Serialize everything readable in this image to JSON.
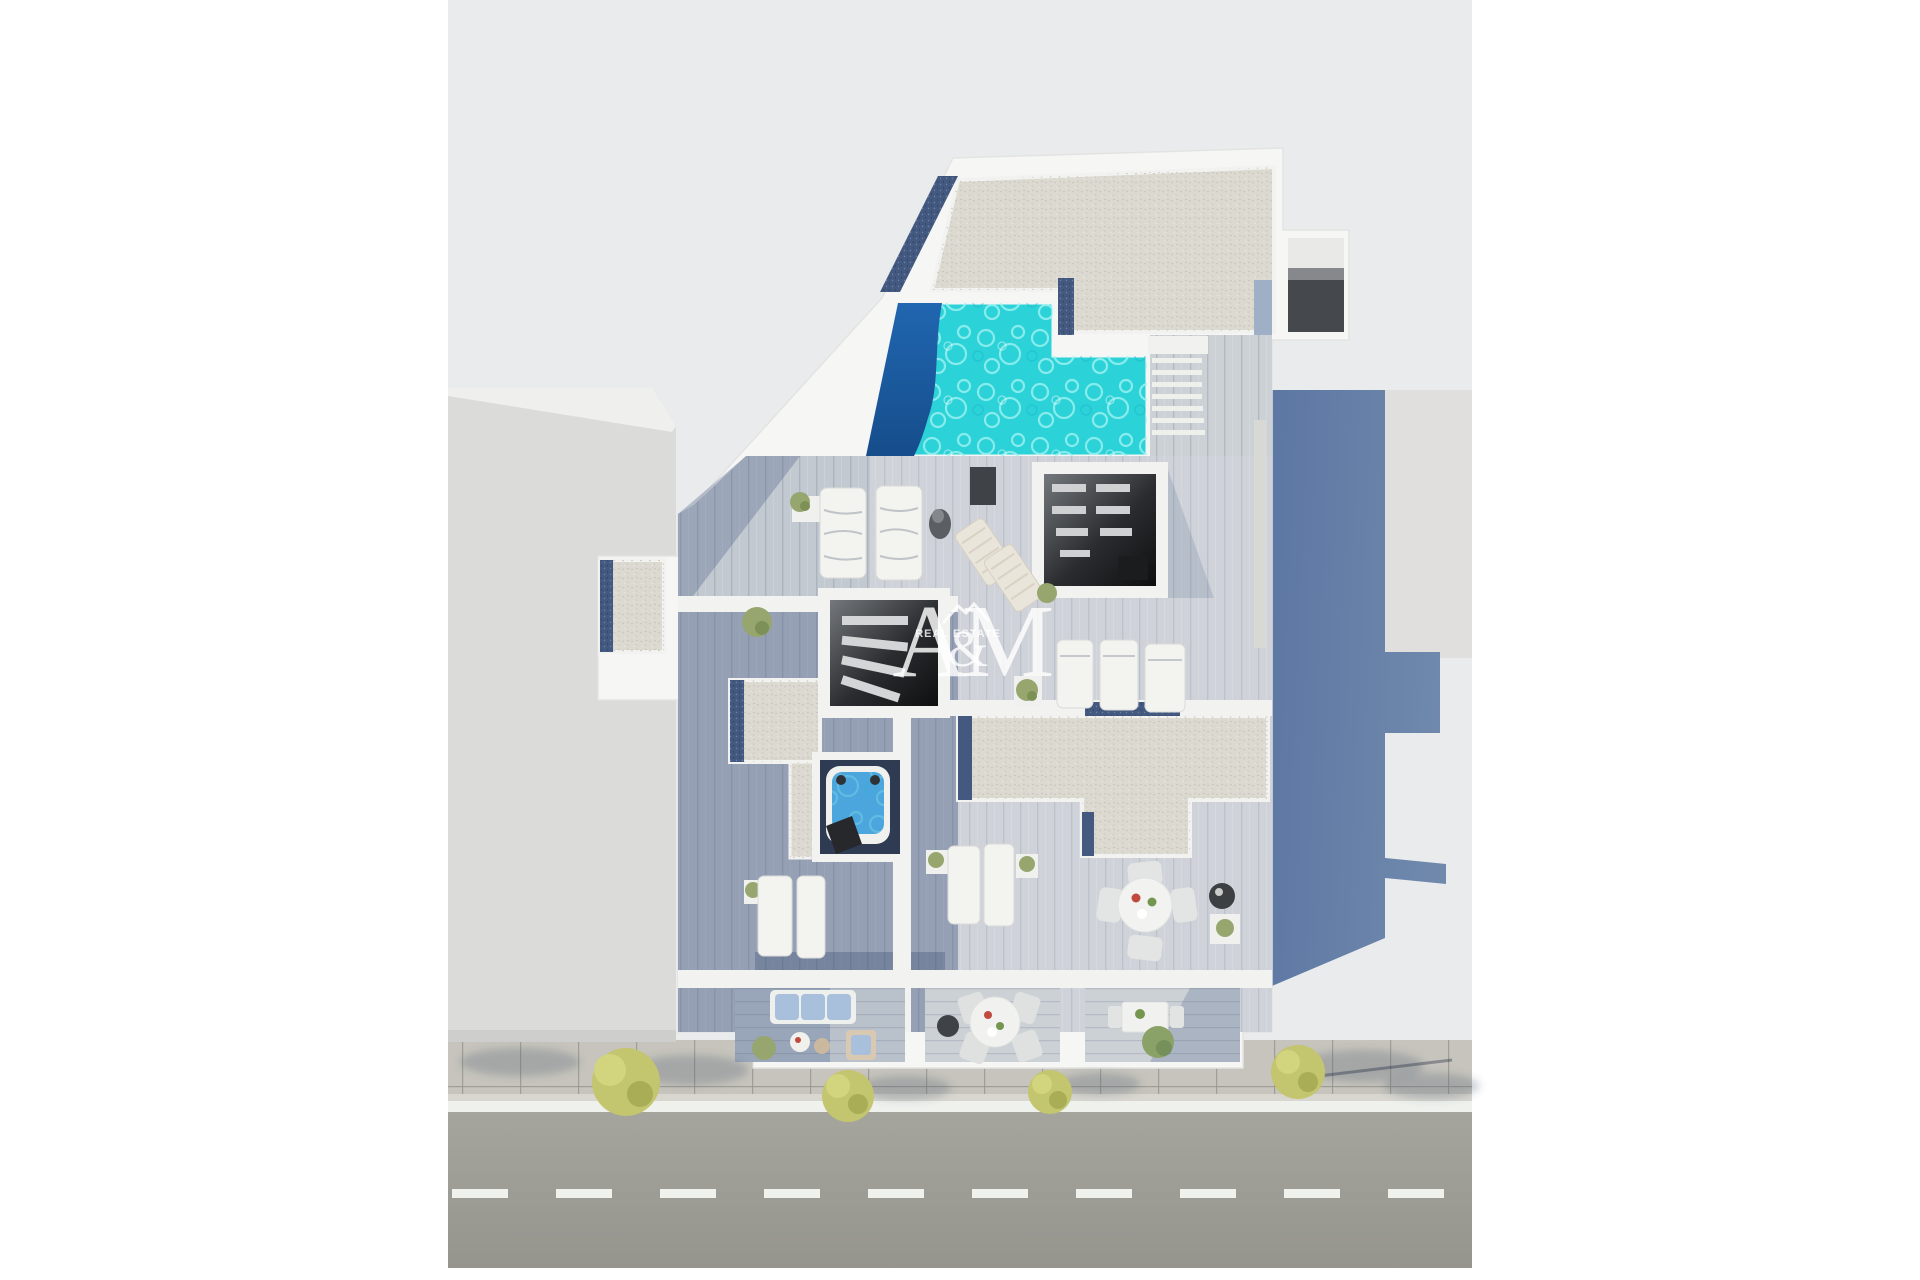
{
  "watermark": {
    "letter_a": "A",
    "ampersand": "&",
    "letter_m": "M",
    "subtitle": "REAL ESTATE"
  },
  "colors": {
    "canvas_white": "#ffffff",
    "scene_bg": "#e9ebed",
    "neighbor_roof_left": "#dbdcda",
    "neighbor_slab_right": "#e0dfdd",
    "building_white": "#f6f7f5",
    "wall_white": "#f2f3f0",
    "gravel": "#dcd9d1",
    "gravel_edge_navy": "#44597f",
    "pool_shallow": "#2bd2d8",
    "pool_deep": "#1b5da7",
    "deck_wood": "#c3c9d0",
    "cast_shadow_blue": "#5f79a4",
    "room_dark": "#1a1c1e",
    "doorway_dark": "#45494d",
    "hot_tub_water": "#4aa6dc",
    "hot_tub_floor": "#2e3b52",
    "sidewalk": "#c6c4bc",
    "road": "#9c9c95",
    "road_line": "#eff1ed",
    "tree_yellow": "#c3c56f",
    "tree_green": "#8aa268",
    "plant_green": "#97a66f",
    "cushion_blue": "#a8c0dc",
    "lounger_white": "#f3f3f0",
    "slat_lounger": "#e9e5da",
    "accent_red": "#c14a40",
    "accent_green": "#74964f",
    "dark_object": "#3f4247",
    "watermark_white": "rgba(255,255,255,0.82)"
  }
}
